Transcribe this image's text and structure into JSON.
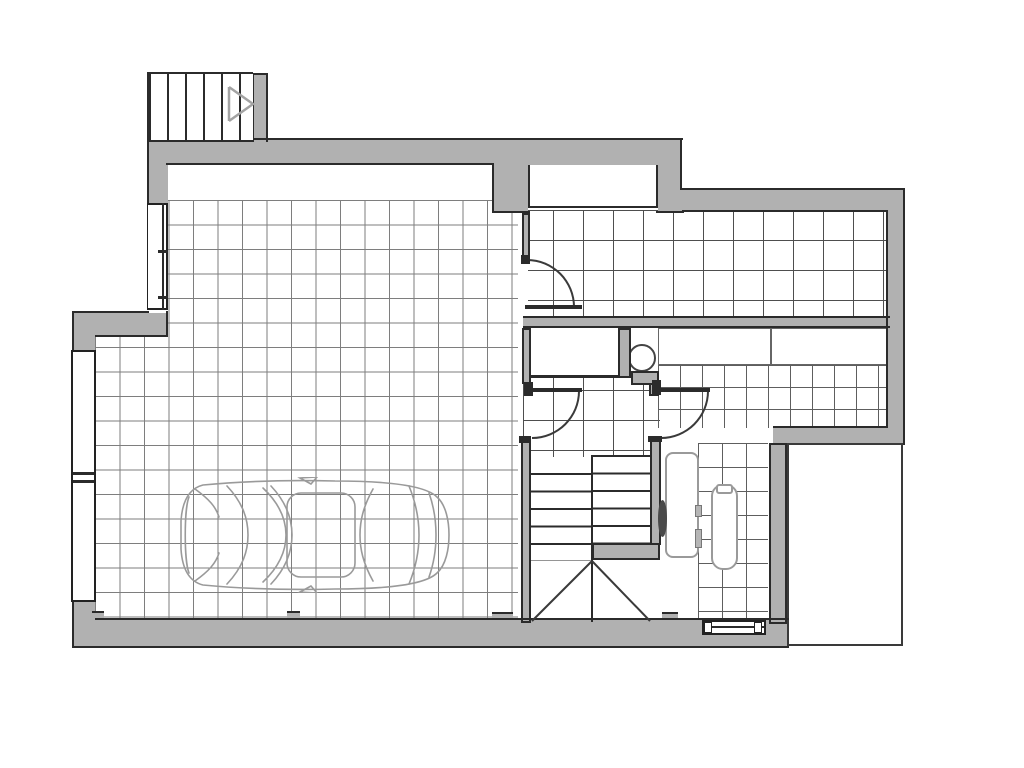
{
  "drawing": {
    "type": "architectural-floor-plan",
    "title": "Ground floor plan (unlabeled drawing, no visible text)",
    "regions": [
      {
        "name": "exterior-entry-stair",
        "note": "hatched steps with direction arrow, top-left, outside the walls"
      },
      {
        "name": "upper-left-tiled-room",
        "note": "tiled floor, window on left wall"
      },
      {
        "name": "upper-right-tiled-hall",
        "note": "tiled floor with wall niche at top"
      },
      {
        "name": "kitchen-area",
        "note": "counter band with divider, small floor tiles"
      },
      {
        "name": "central-hallway",
        "note": "closet recess and round washbasin nook"
      },
      {
        "name": "garage",
        "note": "large tiled floor with car parked, glazed opening on left wall"
      },
      {
        "name": "internal-staircase",
        "note": "two flights with center divider and diagonal under-stair marks"
      },
      {
        "name": "bathroom",
        "note": "small tiles, shower tray, bathtub, window in bottom wall"
      },
      {
        "name": "terrace",
        "note": "white rectangle with thin outline, bottom-right, outside heated area"
      }
    ],
    "fixtures": [
      "car-top-view",
      "kitchen-counter",
      "round-washbasin",
      "closet-niche",
      "shower-tray",
      "bathtub",
      "bathtub-taps",
      "interior-stairs",
      "exterior-stairs",
      "stair-direction-arrow",
      "window-upper-left",
      "window-garage-left",
      "window-bathroom-bottom",
      "door-swing-arcs"
    ],
    "door_count": 4
  },
  "palette": {
    "background": "#ffffff",
    "wall-fill": "#b1b1b1",
    "wall-edge": "#2b2b2b",
    "tile-line-a": "#7e7e7e",
    "tile-line-b": "#4e4e4e",
    "tile-line-c": "#5e5e5e",
    "door-line": "#3a3a3a",
    "fixture-line": "#9a9a9a",
    "car-line": "#9a9a9a",
    "arrow-line": "#a3a3a3",
    "window-line": "#222222"
  }
}
